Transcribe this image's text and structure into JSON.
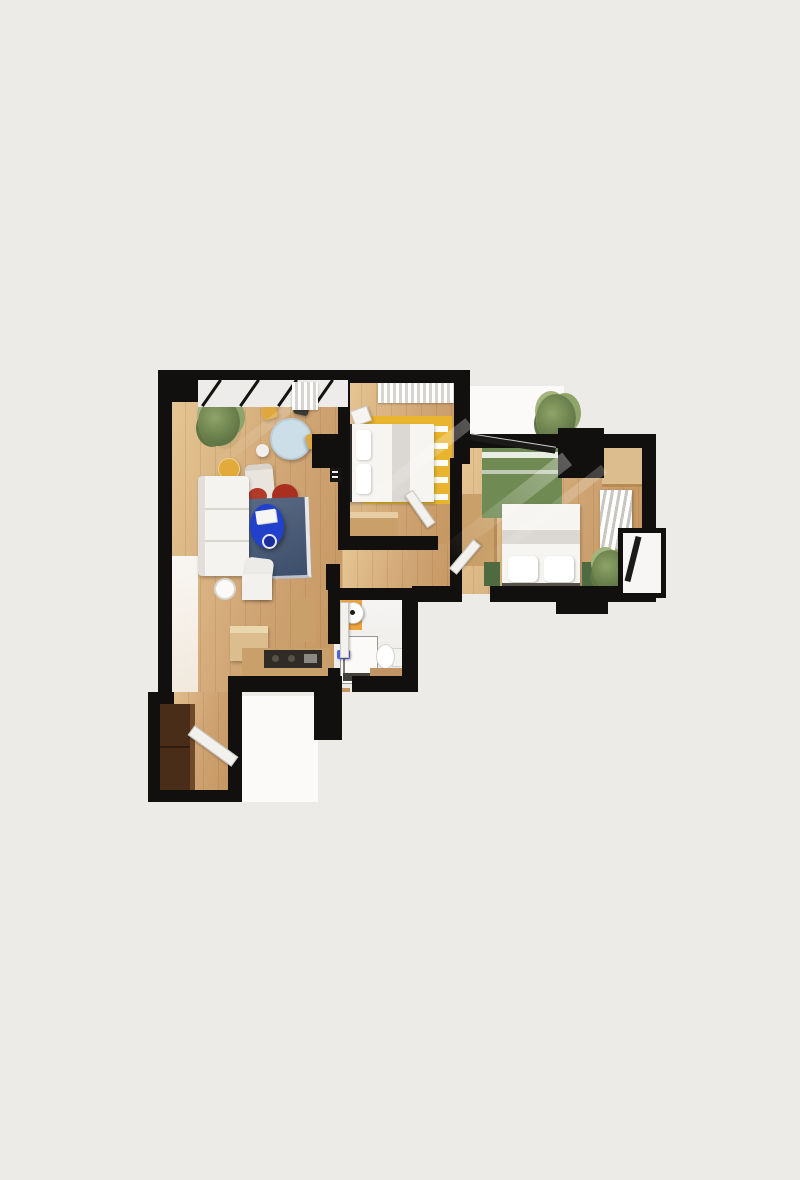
{
  "meta": {
    "description": "3D top-down architectural render of a two-bedroom apartment floor plan on a plain light-grey background",
    "visible_text": []
  },
  "palette": {
    "background": "#ecebe8",
    "slab_white": "#fbfaf8",
    "wall": "#11100e",
    "floor_a": "#e6c795",
    "floor_b": "#d0a574",
    "floor_c": "#c3945e",
    "soft_white": "#f2f1ee",
    "rug_navy_a": "#5a6a84",
    "rug_navy_b": "#3c4e6a",
    "coffee_table_blue": "#2140cc",
    "tray_blue": "#1a2f9e",
    "pouf_red": "#ab2f20",
    "cushion_red": "#b23a28",
    "chair_yellow": "#dfa83e",
    "dining_table_top": "#ccdfe9",
    "side_table_yellow": "#e2a93b",
    "rug_yellow": "#e9b52f",
    "rug_green": "#6f8a52",
    "nightstand_green": "#4e6a40",
    "bath_orange": "#f0a23d",
    "shower_blue": "#5064d4",
    "shower_floor": "#44403b",
    "closet_brown": "#4a2d18",
    "closet_brown_light": "#6e4a2a",
    "counter_dark": "#2f2c28",
    "wood_cabinet": "#c9a06a",
    "wood_cabinet_light": "#dcbd8e",
    "plant_a": "#8fa468",
    "plant_b": "#5f7544",
    "bed_band_gray": "#dbd8d4",
    "headboard_dark": "#2f2d2a"
  },
  "scene": {
    "type": "floor-plan-3d-render",
    "rooms": [
      {
        "id": "living-room",
        "furniture": [
          "white-sectional-sofa",
          "navy-rug",
          "blue-coffee-table",
          "magazines",
          "red-pouf",
          "gray-armchair",
          "red-cushion",
          "white-armchair",
          "floor-lamp",
          "yellow-side-table",
          "potted-plant"
        ]
      },
      {
        "id": "dining-area",
        "furniture": [
          "round-dining-table",
          "dining-chair-yellow",
          "dining-chair-dark",
          "dining-chair-white",
          "window-curtain"
        ]
      },
      {
        "id": "bedroom-1",
        "furniture": [
          "double-bed",
          "pillows",
          "yellow-patterned-rug",
          "nightstand",
          "low-dresser",
          "window-curtain"
        ]
      },
      {
        "id": "bedroom-2",
        "furniture": [
          "double-bed",
          "pillows",
          "green-rug",
          "green-nightstand-left",
          "green-nightstand-right",
          "wardrobe-left",
          "wardrobe-top-right",
          "white-radiator-rack",
          "potted-plant"
        ]
      },
      {
        "id": "bathroom",
        "furniture": [
          "round-sink-on-orange-mat",
          "walk-in-shower",
          "blue-shower-handle",
          "toilet",
          "wood-platform"
        ]
      },
      {
        "id": "kitchen",
        "furniture": [
          "l-shaped-counter",
          "dark-cooktop",
          "fridge",
          "tall-cabinet"
        ]
      },
      {
        "id": "entry-hall",
        "furniture": [
          "brown-closet",
          "open-front-door"
        ]
      },
      {
        "id": "hallway",
        "furniture": [
          "open-door-bedroom-1",
          "open-door-bedroom-2",
          "open-door-bathroom"
        ]
      },
      {
        "id": "balconies",
        "furniture": [
          "white-slab-top",
          "potted-plant",
          "white-slab-right",
          "landing-slab-bottom"
        ]
      }
    ]
  }
}
